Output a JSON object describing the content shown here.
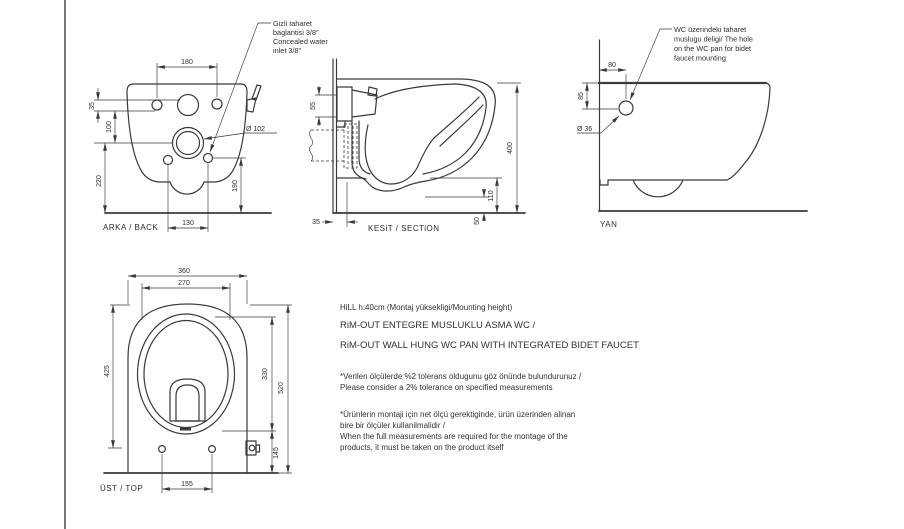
{
  "colors": {
    "ink": "#3a3a3a",
    "paper": "#ffffff"
  },
  "back_view": {
    "label": "ARKA / BACK",
    "d180": "180",
    "d35": "35",
    "d100": "100",
    "d220": "220",
    "d190": "190",
    "d130": "130",
    "dia102": "Ø 102",
    "ann1": "Gizli taharet",
    "ann2": "baglantisi 3/8\"",
    "ann3": "Concealed water",
    "ann4": "inlet 3/8\""
  },
  "section_view": {
    "label": "KESiT / SECTiON",
    "d55": "55",
    "d35": "35",
    "d400": "400",
    "d110": "110",
    "d50": "50"
  },
  "side_view": {
    "label": "YAN",
    "d80": "80",
    "d85": "85",
    "dia36": "Ø 36",
    "ann1": "WC üzerindeki taharet",
    "ann2": "muslugu deligi/ The hole",
    "ann3": "on the WC pan for bidet",
    "ann4": "faucet mounting"
  },
  "top_view": {
    "label": "ÜST / TOP",
    "d360": "360",
    "d270": "270",
    "d425": "425",
    "d330": "330",
    "d520": "520",
    "d145": "145",
    "d155": "155"
  },
  "notes": {
    "title1": "HiLL h:40cm (Montaj yüksekligi/Mounting height)",
    "title2": "RiM-OUT ENTEGRE MUSLUKLU ASMA WC /",
    "title3": "RiM-OUT WALL HUNG WC PAN WITH INTEGRATED BIDET FAUCET",
    "tol_tr": "*Verilen ölçülerde %2 tolerans oldugunu göz önünde bulundurunuz /",
    "tol_en": "Please consider a 2% tolerance on specified measurements",
    "mon_tr1": "*Ürünlerin montaji için net ölçü gerektiginde, ürün üzerinden alinan",
    "mon_tr2": "bire bir ölçüler kullanilmalidir /",
    "mon_en1": "When the full measurements are required for the montage of the",
    "mon_en2": "products, it must be taken on the product itself"
  }
}
